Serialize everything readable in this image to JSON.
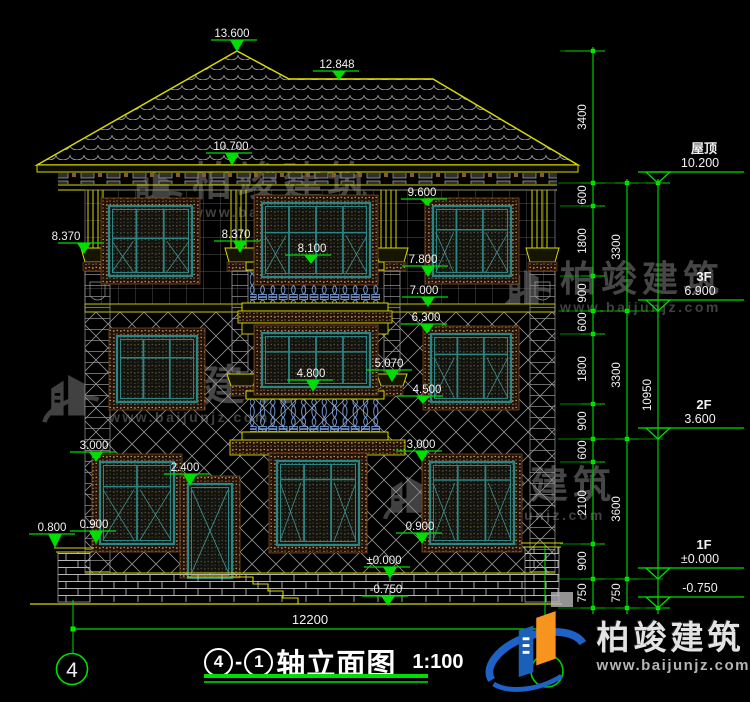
{
  "title_block": {
    "axis_start": "4",
    "separator": "-",
    "axis_end": "1",
    "title": "轴立面图",
    "scale": "1:100"
  },
  "axis_bubbles": {
    "left": "4"
  },
  "bottom_dimension": {
    "value": "12200"
  },
  "elevation_markers": [
    {
      "label": "13.600",
      "tx": 232,
      "ty": 27,
      "ax": 237,
      "ay": 52
    },
    {
      "label": "12.848",
      "tx": 337,
      "ty": 58,
      "ax": 339,
      "ay": 80
    },
    {
      "label": "10.700",
      "tx": 231,
      "ty": 140,
      "ax": 232,
      "ay": 166
    },
    {
      "label": "9.600",
      "tx": 422,
      "ty": 186,
      "ax": 427,
      "ay": 206
    },
    {
      "label": "8.370",
      "tx": 66,
      "ty": 230,
      "ax": 84,
      "ay": 254
    },
    {
      "label": "8.370",
      "tx": 236,
      "ty": 228,
      "ax": 240,
      "ay": 253
    },
    {
      "label": "8.100",
      "tx": 312,
      "ty": 242,
      "ax": 311,
      "ay": 264
    },
    {
      "label": "7.800",
      "tx": 423,
      "ty": 253,
      "ax": 428,
      "ay": 277
    },
    {
      "label": "7.000",
      "tx": 424,
      "ty": 284,
      "ax": 428,
      "ay": 307
    },
    {
      "label": "6.300",
      "tx": 426,
      "ty": 311,
      "ax": 427,
      "ay": 334
    },
    {
      "label": "5.070",
      "tx": 389,
      "ty": 357,
      "ax": 392,
      "ay": 382
    },
    {
      "label": "4.800",
      "tx": 311,
      "ty": 367,
      "ax": 313,
      "ay": 392
    },
    {
      "label": "4.500",
      "tx": 427,
      "ty": 383,
      "ax": 423,
      "ay": 404
    },
    {
      "label": "3.000",
      "tx": 94,
      "ty": 439,
      "ax": 96,
      "ay": 462
    },
    {
      "label": "3.000",
      "tx": 421,
      "ty": 438,
      "ax": 422,
      "ay": 462
    },
    {
      "label": "2.400",
      "tx": 185,
      "ty": 461,
      "ax": 190,
      "ay": 486
    },
    {
      "label": "0.900",
      "tx": 94,
      "ty": 518,
      "ax": 96,
      "ay": 544
    },
    {
      "label": "0.800",
      "tx": 52,
      "ty": 521,
      "ax": 55,
      "ay": 548
    },
    {
      "label": "0.900",
      "tx": 420,
      "ty": 520,
      "ax": 422,
      "ay": 544
    },
    {
      "label": "±0.000",
      "tx": 384,
      "ty": 554,
      "ax": 390,
      "ay": 579
    },
    {
      "label": "-0.750",
      "tx": 386,
      "ty": 583,
      "ax": 388,
      "ay": 606
    }
  ],
  "dimension_chains": [
    {
      "id": "segments",
      "labels": [
        {
          "text": "3400",
          "y": 117
        },
        {
          "text": "600",
          "y": 195
        },
        {
          "text": "1800",
          "y": 241
        },
        {
          "text": "900",
          "y": 293
        },
        {
          "text": "600",
          "y": 322
        },
        {
          "text": "1800",
          "y": 369
        },
        {
          "text": "900",
          "y": 421
        },
        {
          "text": "600",
          "y": 450
        },
        {
          "text": "2100",
          "y": 503
        },
        {
          "text": "900",
          "y": 561
        },
        {
          "text": "750",
          "y": 593
        }
      ]
    },
    {
      "id": "floors",
      "labels": [
        {
          "text": "3300",
          "y": 247
        },
        {
          "text": "3300",
          "y": 375
        },
        {
          "text": "3600",
          "y": 509
        },
        {
          "text": "750",
          "y": 593
        }
      ]
    },
    {
      "id": "total",
      "labels": [
        {
          "text": "10950",
          "y": 395
        }
      ]
    }
  ],
  "floor_levels": [
    {
      "name": "屋顶",
      "elevation": "10.200",
      "y": 183
    },
    {
      "name": "3F",
      "elevation": "6.900",
      "y": 311
    },
    {
      "name": "2F",
      "elevation": "3.600",
      "y": 439
    },
    {
      "name": "1F",
      "elevation": "±0.000",
      "y": 579
    },
    {
      "name": "",
      "elevation": "-0.750",
      "y": 608
    }
  ],
  "watermarks": [
    {
      "text": "柏竣建筑",
      "url": "www.baijunjz.com",
      "x": 126,
      "y": 163,
      "size": 40
    },
    {
      "text": "柏竣建筑",
      "url": "www.baijunjz.com",
      "x": 500,
      "y": 262,
      "size": 36
    },
    {
      "text": "柏竣建筑",
      "url": "www.baijunjz.com",
      "x": 40,
      "y": 366,
      "size": 42
    },
    {
      "text": "柏竣建筑",
      "url": "www.baijunjz.com",
      "x": 381,
      "y": 468,
      "size": 38
    }
  ],
  "logo": {
    "name": "柏竣建筑",
    "url": "www.baijunjz.com"
  }
}
